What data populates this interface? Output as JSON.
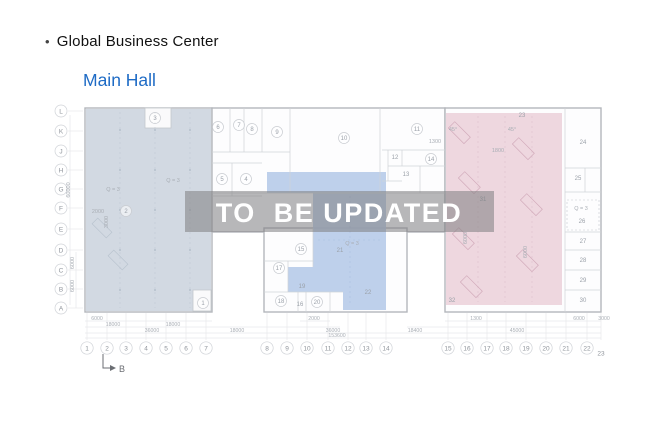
{
  "header": {
    "bullet": "•",
    "title": "Global Business Center",
    "subtitle": "Main Hall"
  },
  "watermark": {
    "text": "TO  BE UPDATED"
  },
  "colors": {
    "accent_blue": "#1e6bc5",
    "region_left": "#cdd5df",
    "region_middle": "#b7cbe9",
    "region_right": "#ecd3dc",
    "band": "rgba(125,125,128,0.55)",
    "wall": "#b4b7bc",
    "line": "#cfd3d8",
    "label": "#9aa0a8"
  },
  "plan": {
    "row_axes": [
      {
        "label": "L",
        "x": 61,
        "y": 111
      },
      {
        "label": "K",
        "x": 61,
        "y": 131
      },
      {
        "label": "J",
        "x": 61,
        "y": 151
      },
      {
        "label": "H",
        "x": 61,
        "y": 170
      },
      {
        "label": "G",
        "x": 61,
        "y": 189
      },
      {
        "label": "F",
        "x": 61,
        "y": 208
      },
      {
        "label": "E",
        "x": 61,
        "y": 229
      },
      {
        "label": "D",
        "x": 61,
        "y": 250
      },
      {
        "label": "C",
        "x": 61,
        "y": 270
      },
      {
        "label": "B",
        "x": 61,
        "y": 289
      },
      {
        "label": "A",
        "x": 61,
        "y": 308
      }
    ],
    "col_axes": [
      {
        "label": "1",
        "x": 87,
        "y": 348
      },
      {
        "label": "2",
        "x": 107,
        "y": 348
      },
      {
        "label": "3",
        "x": 126,
        "y": 348
      },
      {
        "label": "4",
        "x": 146,
        "y": 348
      },
      {
        "label": "5",
        "x": 166,
        "y": 348
      },
      {
        "label": "6",
        "x": 186,
        "y": 348
      },
      {
        "label": "7",
        "x": 206,
        "y": 348
      },
      {
        "label": "8",
        "x": 267,
        "y": 348
      },
      {
        "label": "9",
        "x": 287,
        "y": 348
      },
      {
        "label": "10",
        "x": 307,
        "y": 348
      },
      {
        "label": "11",
        "x": 328,
        "y": 348
      },
      {
        "label": "12",
        "x": 348,
        "y": 348
      },
      {
        "label": "13",
        "x": 366,
        "y": 348
      },
      {
        "label": "14",
        "x": 386,
        "y": 348
      },
      {
        "label": "15",
        "x": 448,
        "y": 348
      },
      {
        "label": "16",
        "x": 467,
        "y": 348
      },
      {
        "label": "17",
        "x": 487,
        "y": 348
      },
      {
        "label": "18",
        "x": 506,
        "y": 348
      },
      {
        "label": "19",
        "x": 526,
        "y": 348
      },
      {
        "label": "20",
        "x": 546,
        "y": 348
      },
      {
        "label": "21",
        "x": 566,
        "y": 348
      },
      {
        "label": "22",
        "x": 587,
        "y": 348
      },
      {
        "label": "23",
        "x": 601,
        "y": 353,
        "circle": false
      }
    ],
    "rooms": [
      {
        "n": "1",
        "x": 203,
        "y": 303,
        "c": true
      },
      {
        "n": "2",
        "x": 126,
        "y": 211,
        "c": true
      },
      {
        "n": "3",
        "x": 155,
        "y": 118,
        "c": true
      },
      {
        "n": "4",
        "x": 246,
        "y": 179,
        "c": true
      },
      {
        "n": "5",
        "x": 222,
        "y": 179,
        "c": true
      },
      {
        "n": "6",
        "x": 218,
        "y": 127,
        "c": true
      },
      {
        "n": "7",
        "x": 239,
        "y": 125,
        "c": true
      },
      {
        "n": "8",
        "x": 252,
        "y": 129,
        "c": true
      },
      {
        "n": "9",
        "x": 277,
        "y": 132,
        "c": true
      },
      {
        "n": "10",
        "x": 344,
        "y": 138,
        "c": true
      },
      {
        "n": "11",
        "x": 417,
        "y": 129,
        "c": true
      },
      {
        "n": "12",
        "x": 395,
        "y": 157,
        "c": false
      },
      {
        "n": "13",
        "x": 406,
        "y": 174,
        "c": false
      },
      {
        "n": "14",
        "x": 431,
        "y": 159,
        "c": true
      },
      {
        "n": "15",
        "x": 301,
        "y": 249,
        "c": true
      },
      {
        "n": "16",
        "x": 300,
        "y": 304,
        "c": false
      },
      {
        "n": "17",
        "x": 279,
        "y": 268,
        "c": true
      },
      {
        "n": "18",
        "x": 281,
        "y": 301,
        "c": true
      },
      {
        "n": "19",
        "x": 302,
        "y": 286,
        "c": false
      },
      {
        "n": "20",
        "x": 317,
        "y": 302,
        "c": true
      },
      {
        "n": "21",
        "x": 340,
        "y": 250,
        "c": false
      },
      {
        "n": "22",
        "x": 368,
        "y": 292,
        "c": false
      },
      {
        "n": "23",
        "x": 522,
        "y": 115,
        "c": false
      },
      {
        "n": "24",
        "x": 583,
        "y": 142,
        "c": false
      },
      {
        "n": "25",
        "x": 578,
        "y": 178,
        "c": false
      },
      {
        "n": "26",
        "x": 582,
        "y": 221,
        "c": false
      },
      {
        "n": "27",
        "x": 583,
        "y": 241,
        "c": false
      },
      {
        "n": "28",
        "x": 583,
        "y": 260,
        "c": false
      },
      {
        "n": "29",
        "x": 583,
        "y": 280,
        "c": false
      },
      {
        "n": "30",
        "x": 583,
        "y": 300,
        "c": false
      },
      {
        "n": "31",
        "x": 483,
        "y": 199,
        "c": false
      },
      {
        "n": "32",
        "x": 452,
        "y": 300,
        "c": false
      }
    ],
    "annotations": [
      {
        "t": "Q = 3",
        "x": 173,
        "y": 182
      },
      {
        "t": "Q = 3",
        "x": 113,
        "y": 191
      },
      {
        "t": "Q = 3",
        "x": 352,
        "y": 245
      },
      {
        "t": "Q = 3",
        "x": 581,
        "y": 210
      },
      {
        "t": "2000",
        "x": 98,
        "y": 213
      },
      {
        "t": "1300",
        "x": 435,
        "y": 143
      },
      {
        "t": "1800",
        "x": 498,
        "y": 152
      },
      {
        "t": "45°",
        "x": 453,
        "y": 131
      },
      {
        "t": "45°",
        "x": 512,
        "y": 131
      },
      {
        "t": "60000",
        "x": 70,
        "y": 190,
        "rot": -90
      },
      {
        "t": "6000",
        "x": 74,
        "y": 263,
        "rot": -90
      },
      {
        "t": "6000",
        "x": 74,
        "y": 286,
        "rot": -90
      },
      {
        "t": "3000",
        "x": 108,
        "y": 222,
        "rot": -90
      },
      {
        "t": "6000",
        "x": 467,
        "y": 238,
        "rot": -90
      },
      {
        "t": "6000",
        "x": 527,
        "y": 252,
        "rot": -90
      }
    ],
    "dims_bottom": [
      {
        "t": "6000",
        "x": 97,
        "y": 320
      },
      {
        "t": "18000",
        "x": 113,
        "y": 326
      },
      {
        "t": "18000",
        "x": 173,
        "y": 326
      },
      {
        "t": "36000",
        "x": 152,
        "y": 332
      },
      {
        "t": "18000",
        "x": 237,
        "y": 332
      },
      {
        "t": "2000",
        "x": 314,
        "y": 320
      },
      {
        "t": "36000",
        "x": 333,
        "y": 332
      },
      {
        "t": "153600",
        "x": 337,
        "y": 337
      },
      {
        "t": "1300",
        "x": 476,
        "y": 320
      },
      {
        "t": "18400",
        "x": 415,
        "y": 332
      },
      {
        "t": "45000",
        "x": 517,
        "y": 332
      },
      {
        "t": "6000",
        "x": 579,
        "y": 320
      },
      {
        "t": "3000",
        "x": 604,
        "y": 320
      }
    ],
    "section_marker": {
      "label": "B"
    }
  }
}
